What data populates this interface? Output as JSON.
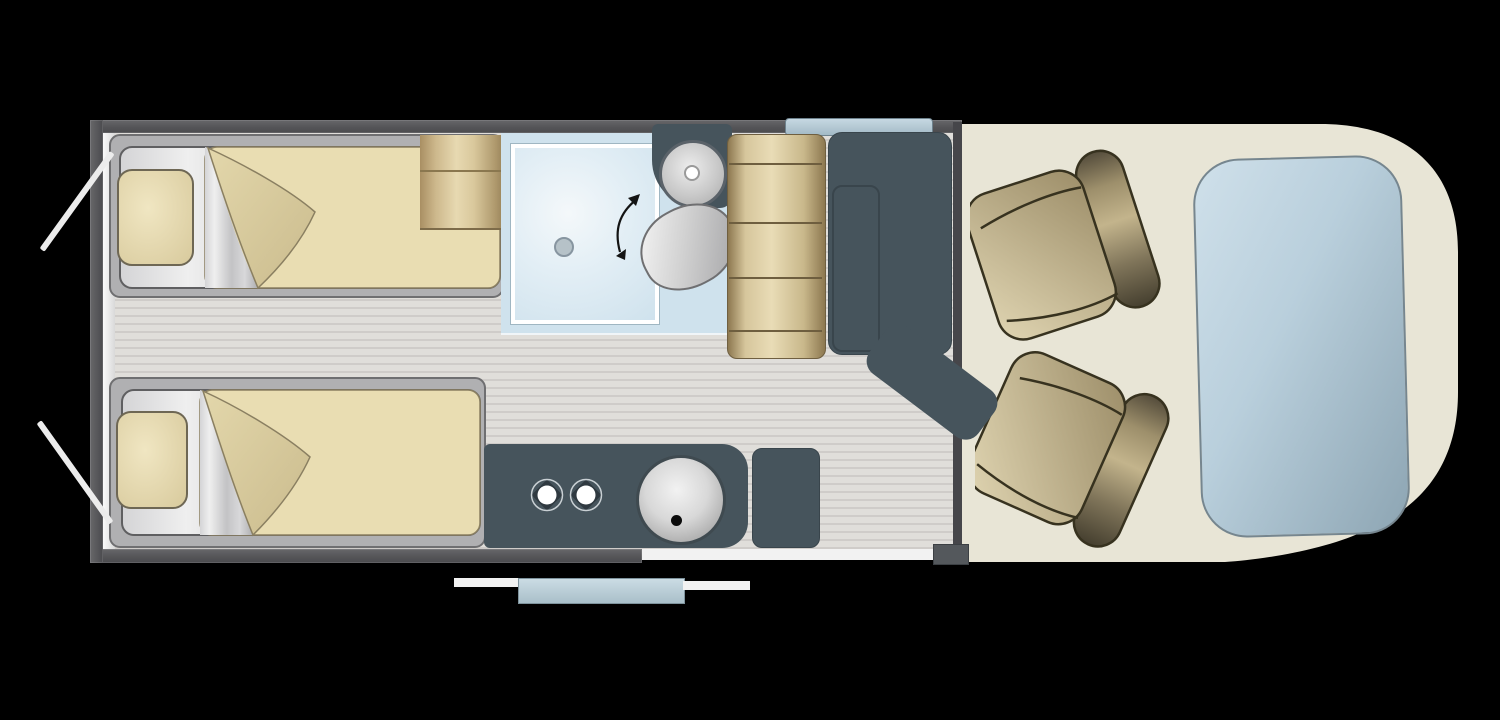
{
  "scene": {
    "title": "Campervan floor plan (top view)",
    "view": "overhead",
    "text_visible": "none"
  },
  "colors": {
    "bg": "#000000",
    "wall": "#555558",
    "floor_a": "#e0deda",
    "floor_b": "#cfccc9",
    "teal": "#46545c",
    "cream": "#e8e5d6",
    "bath_blue": "#cfe2ed",
    "bench_mid": "#e9dcb6",
    "bed_fabric": "#e9ddb2",
    "bed_fold": "#d9cb9e",
    "mattress": "#c9c9cb",
    "pillow": "#eee3bd",
    "seat_light": "#dcd1ae",
    "seat_dark": "#544c3b",
    "windshield_light": "#cfe0ea",
    "windshield_dark": "#8da5b3",
    "window_blue": "#b9ccd7",
    "step_blue": "#a9bfc9",
    "white": "#f2f2f2"
  },
  "furniture": {
    "bed_top": {
      "label": "Single bed (rear left)"
    },
    "bed_bottom": {
      "label": "Single bed (rear right)"
    },
    "wardrobe": {
      "label": "Wardrobe"
    },
    "shower": {
      "label": "Shower cubicle"
    },
    "washbasin": {
      "label": "Washbasin"
    },
    "toilet": {
      "label": "Swivel toilet"
    },
    "bench": {
      "label": "Dinette bench seat"
    },
    "table": {
      "label": "Table"
    },
    "kitchen": {
      "label": "Kitchen unit"
    },
    "hob": {
      "label": "Two-burner hob"
    },
    "kitchen_sink": {
      "label": "Kitchen sink"
    },
    "fridge": {
      "label": "Fridge / cabinet"
    },
    "seat_driver": {
      "label": "Swivelled cab seat (upper)"
    },
    "seat_passenger": {
      "label": "Swivelled cab seat (lower)"
    },
    "windshield": {
      "label": "Windscreen"
    },
    "window": {
      "label": "Window"
    },
    "entry_step": {
      "label": "Entry step"
    },
    "rear_doors": {
      "label": "Open rear doors"
    },
    "sliding_door": {
      "label": "Sliding-door opening"
    },
    "cab_floor": {
      "label": "Cab floor"
    }
  }
}
